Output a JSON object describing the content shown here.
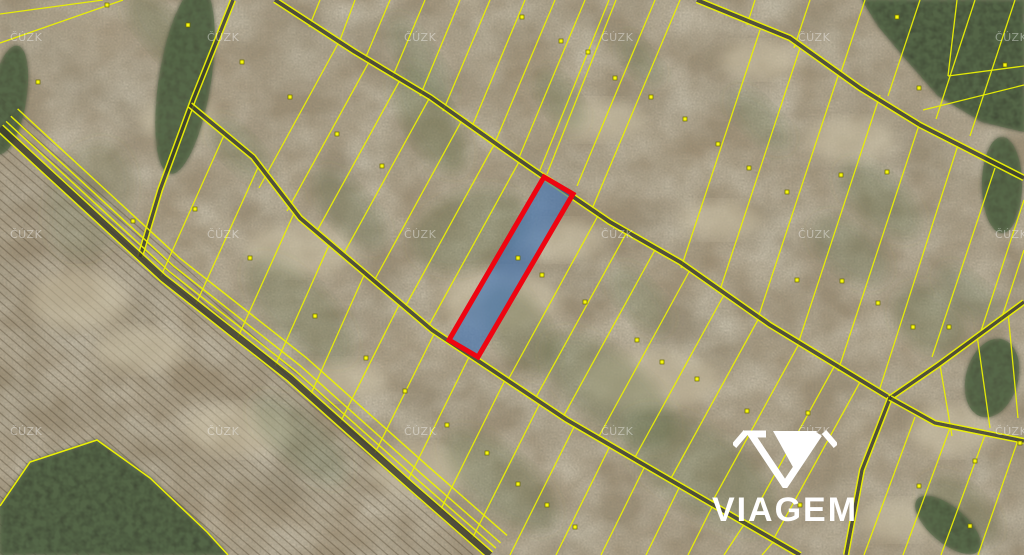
{
  "branding": {
    "logo_text": "VIAGEM"
  },
  "watermark": {
    "text": "ČÚZK",
    "grid_x": [
      10,
      207,
      404,
      601,
      798,
      995
    ],
    "grid_y": [
      41,
      238,
      435
    ],
    "color": "rgba(255,255,255,0.38)"
  },
  "map": {
    "background": "#a29176",
    "line_color": "#eaf005",
    "road_core_color": "#3c3c2b",
    "highlight": {
      "fill": "rgba(58,114,184,0.60)",
      "stroke": "#ee0511",
      "stroke_width": 5,
      "polygon": [
        [
          544,
          177
        ],
        [
          573,
          194
        ],
        [
          478,
          357
        ],
        [
          449,
          340
        ]
      ]
    },
    "roads": [
      {
        "pts": [
          [
            233,
            0
          ],
          [
            193,
            100
          ],
          [
            160,
            190
          ],
          [
            140,
            257
          ]
        ],
        "gap": 2.4
      },
      {
        "pts": [
          [
            697,
            0
          ],
          [
            790,
            38
          ],
          [
            860,
            88
          ],
          [
            920,
            125
          ],
          [
            1024,
            178
          ]
        ],
        "gap": 2.6
      },
      {
        "pts": [
          [
            275,
            0
          ],
          [
            355,
            52
          ],
          [
            430,
            97
          ],
          [
            505,
            150
          ],
          [
            544,
            177
          ],
          [
            610,
            222
          ],
          [
            680,
            262
          ],
          [
            770,
            325
          ],
          [
            890,
            398
          ]
        ],
        "gap": 2.6
      },
      {
        "pts": [
          [
            890,
            398
          ],
          [
            938,
            365
          ],
          [
            1024,
            302
          ]
        ],
        "gap": 2.4
      },
      {
        "pts": [
          [
            890,
            398
          ],
          [
            862,
            470
          ],
          [
            846,
            555
          ]
        ],
        "gap": 2.4
      },
      {
        "pts": [
          [
            890,
            398
          ],
          [
            935,
            423
          ],
          [
            1024,
            441
          ]
        ],
        "gap": 2.4
      },
      {
        "pts": [
          [
            190,
            105
          ],
          [
            253,
            157
          ],
          [
            300,
            218
          ],
          [
            432,
            330
          ],
          [
            567,
            420
          ],
          [
            710,
            503
          ],
          [
            800,
            555
          ]
        ],
        "gap": 2.6
      },
      {
        "pts": [
          [
            0,
            128
          ],
          [
            163,
            278
          ],
          [
            290,
            378
          ],
          [
            410,
            485
          ],
          [
            490,
            555
          ]
        ],
        "gap": 4,
        "core": 6.5,
        "extras": [
          -9,
          -16,
          -26
        ]
      }
    ],
    "strips": [
      [
        0,
        14,
        103,
        0
      ],
      [
        0,
        43,
        123,
        0
      ],
      [
        320,
        0,
        309,
        27
      ],
      [
        355,
        0,
        340,
        40
      ],
      [
        390,
        0,
        365,
        59
      ],
      [
        425,
        0,
        392,
        78
      ],
      [
        460,
        0,
        420,
        96
      ],
      [
        490,
        0,
        443,
        111
      ],
      [
        525,
        0,
        471,
        129
      ],
      [
        555,
        0,
        494,
        145
      ],
      [
        585,
        0,
        518,
        160
      ],
      [
        609,
        0,
        540,
        170
      ],
      [
        616,
        0,
        547,
        174
      ],
      [
        655,
        0,
        577,
        186
      ],
      [
        680,
        0,
        592,
        209
      ],
      [
        755,
        0,
        747,
        25
      ],
      [
        810,
        0,
        794,
        48
      ],
      [
        865,
        0,
        841,
        72
      ],
      [
        920,
        0,
        888,
        96
      ],
      [
        975,
        0,
        936,
        119
      ],
      [
        1015,
        0,
        970,
        136
      ],
      [
        760,
        30,
        681,
        268
      ],
      [
        800,
        48,
        719,
        293
      ],
      [
        840,
        70,
        758,
        318
      ],
      [
        880,
        95,
        798,
        344
      ],
      [
        920,
        122,
        838,
        371
      ],
      [
        958,
        145,
        880,
        388
      ],
      [
        995,
        168,
        932,
        357
      ],
      [
        1024,
        200,
        981,
        331
      ],
      [
        1024,
        250,
        1001,
        320
      ],
      [
        948,
        76,
        1024,
        66
      ],
      [
        923,
        110,
        1024,
        85
      ],
      [
        957,
        0,
        948,
        76
      ],
      [
        340,
        40,
        259,
        188
      ],
      [
        370,
        60,
        287,
        211
      ],
      [
        400,
        80,
        317,
        231
      ],
      [
        430,
        97,
        343,
        255
      ],
      [
        462,
        120,
        374,
        281
      ],
      [
        495,
        143,
        405,
        307
      ],
      [
        520,
        160,
        428,
        327
      ],
      [
        600,
        212,
        508,
        380
      ],
      [
        628,
        230,
        535,
        399
      ],
      [
        656,
        248,
        563,
        417
      ],
      [
        690,
        270,
        598,
        438
      ],
      [
        725,
        293,
        634,
        459
      ],
      [
        760,
        316,
        670,
        480
      ],
      [
        800,
        342,
        711,
        504
      ],
      [
        835,
        365,
        747,
        525
      ],
      [
        860,
        382,
        773,
        540
      ],
      [
        225,
        133,
        161,
        276
      ],
      [
        260,
        163,
        196,
        304
      ],
      [
        295,
        211,
        238,
        337
      ],
      [
        330,
        243,
        275,
        366
      ],
      [
        365,
        273,
        310,
        396
      ],
      [
        400,
        303,
        340,
        423
      ],
      [
        435,
        332,
        375,
        453
      ],
      [
        470,
        355,
        407,
        482
      ],
      [
        505,
        380,
        440,
        511
      ],
      [
        540,
        403,
        472,
        539
      ],
      [
        575,
        425,
        510,
        555
      ],
      [
        610,
        446,
        556,
        555
      ],
      [
        645,
        466,
        601,
        555
      ],
      [
        680,
        486,
        646,
        555
      ],
      [
        713,
        505,
        688,
        555
      ],
      [
        745,
        523,
        724,
        555
      ],
      [
        775,
        540,
        762,
        555
      ],
      [
        940,
        365,
        952,
        436
      ],
      [
        977,
        335,
        990,
        428
      ],
      [
        1008,
        312,
        1018,
        418
      ],
      [
        915,
        417,
        864,
        555
      ],
      [
        950,
        428,
        903,
        555
      ],
      [
        985,
        435,
        941,
        555
      ],
      [
        1018,
        440,
        978,
        555
      ]
    ],
    "boundary_polylines": [
      [
        [
          0,
          506
        ],
        [
          30,
          462
        ],
        [
          97,
          440
        ],
        [
          150,
          478
        ],
        [
          207,
          532
        ],
        [
          228,
          555
        ]
      ]
    ],
    "forest_polygons": [
      [
        [
          862,
          0
        ],
        [
          1024,
          0
        ],
        [
          1024,
          132
        ],
        [
          982,
          122
        ],
        [
          938,
          96
        ],
        [
          903,
          56
        ],
        [
          878,
          26
        ]
      ],
      [
        [
          0,
          555
        ],
        [
          0,
          506
        ],
        [
          30,
          462
        ],
        [
          97,
          440
        ],
        [
          150,
          478
        ],
        [
          207,
          532
        ],
        [
          228,
          555
        ]
      ]
    ],
    "forest_ellipses": [
      [
        8,
        100,
        18,
        55,
        10
      ],
      [
        185,
        80,
        26,
        95,
        9
      ],
      [
        1002,
        185,
        20,
        48,
        0
      ],
      [
        948,
        525,
        40,
        18,
        40
      ],
      [
        992,
        378,
        26,
        40,
        15
      ]
    ],
    "green_patches": [
      [
        430,
        120,
        60,
        25,
        60,
        0.32
      ],
      [
        470,
        230,
        38,
        60,
        70,
        0.28
      ],
      [
        520,
        330,
        50,
        28,
        55,
        0.3
      ],
      [
        300,
        310,
        70,
        30,
        45,
        0.22
      ],
      [
        610,
        390,
        80,
        35,
        40,
        0.28
      ],
      [
        700,
        470,
        90,
        40,
        35,
        0.28
      ],
      [
        500,
        480,
        70,
        30,
        40,
        0.28
      ],
      [
        640,
        300,
        40,
        20,
        50,
        0.22
      ],
      [
        350,
        210,
        50,
        22,
        48,
        0.25
      ],
      [
        560,
        100,
        35,
        18,
        55,
        0.28
      ],
      [
        850,
        250,
        45,
        25,
        40,
        0.25
      ],
      [
        930,
        320,
        40,
        30,
        40,
        0.28
      ],
      [
        970,
        295,
        40,
        18,
        40,
        0.25
      ],
      [
        760,
        120,
        40,
        18,
        45,
        0.22
      ],
      [
        880,
        200,
        50,
        25,
        42,
        0.28
      ],
      [
        640,
        60,
        30,
        15,
        50,
        0.22
      ],
      [
        240,
        150,
        40,
        18,
        45,
        0.22
      ],
      [
        960,
        510,
        45,
        25,
        40,
        0.3
      ],
      [
        300,
        440,
        60,
        25,
        42,
        0.25
      ],
      [
        160,
        30,
        45,
        20,
        50,
        0.3
      ],
      [
        90,
        200,
        40,
        60,
        20,
        0.18
      ],
      [
        420,
        60,
        50,
        18,
        55,
        0.25
      ]
    ],
    "light_patches": [
      [
        500,
        300,
        60,
        30
      ],
      [
        650,
        380,
        70,
        30
      ],
      [
        420,
        470,
        50,
        25
      ],
      [
        850,
        140,
        45,
        22
      ],
      [
        300,
        250,
        55,
        25
      ],
      [
        950,
        430,
        40,
        25
      ],
      [
        760,
        60,
        40,
        18
      ],
      [
        180,
        120,
        40,
        20
      ],
      [
        80,
        300,
        50,
        30
      ],
      [
        240,
        430,
        55,
        25
      ],
      [
        600,
        120,
        45,
        20
      ],
      [
        900,
        520,
        40,
        20
      ],
      [
        560,
        240,
        40,
        20
      ],
      [
        140,
        350,
        45,
        22
      ],
      [
        340,
        380,
        45,
        20
      ],
      [
        720,
        220,
        40,
        18
      ]
    ],
    "plow_region": [
      [
        0,
        95
      ],
      [
        120,
        205
      ],
      [
        300,
        375
      ],
      [
        488,
        548
      ],
      [
        488,
        555
      ],
      [
        0,
        555
      ]
    ],
    "dots": [
      [
        38,
        82
      ],
      [
        107,
        5
      ],
      [
        188,
        25
      ],
      [
        242,
        62
      ],
      [
        290,
        97
      ],
      [
        337,
        134
      ],
      [
        382,
        166
      ],
      [
        195,
        209
      ],
      [
        133,
        221
      ],
      [
        250,
        258
      ],
      [
        522,
        17
      ],
      [
        561,
        41
      ],
      [
        588,
        52
      ],
      [
        615,
        78
      ],
      [
        651,
        97
      ],
      [
        685,
        119
      ],
      [
        718,
        144
      ],
      [
        749,
        168
      ],
      [
        787,
        192
      ],
      [
        841,
        175
      ],
      [
        887,
        172
      ],
      [
        897,
        17
      ],
      [
        919,
        88
      ],
      [
        1005,
        65
      ],
      [
        518,
        258
      ],
      [
        542,
        275
      ],
      [
        585,
        302
      ],
      [
        315,
        316
      ],
      [
        366,
        358
      ],
      [
        405,
        391
      ],
      [
        447,
        425
      ],
      [
        487,
        453
      ],
      [
        518,
        484
      ],
      [
        547,
        505
      ],
      [
        575,
        527
      ],
      [
        637,
        340
      ],
      [
        662,
        362
      ],
      [
        697,
        379
      ],
      [
        747,
        411
      ],
      [
        808,
        413
      ],
      [
        797,
        280
      ],
      [
        842,
        281
      ],
      [
        878,
        303
      ],
      [
        913,
        327
      ],
      [
        949,
        327
      ],
      [
        975,
        461
      ],
      [
        919,
        486
      ],
      [
        800,
        505
      ],
      [
        970,
        526
      ],
      [
        1020,
        443
      ]
    ],
    "dot_fill": "#f7f70f",
    "dot_stroke": "#6b6b00"
  }
}
